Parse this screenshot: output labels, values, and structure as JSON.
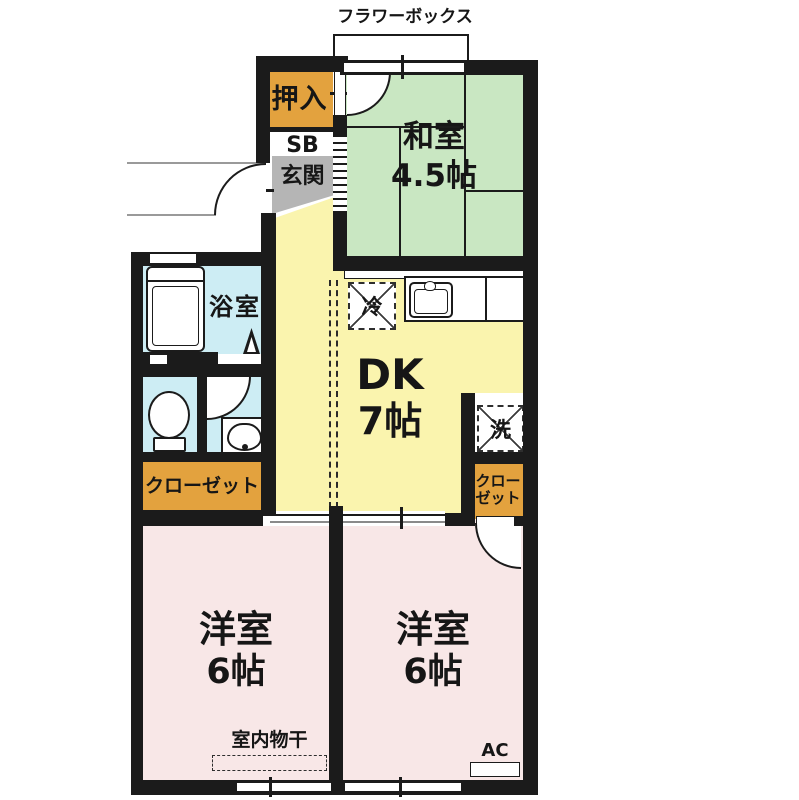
{
  "plan_title": "2DK apartment floor plan",
  "rooms": {
    "washitsu": {
      "name": "和室",
      "size": "4.5帖"
    },
    "dk": {
      "name": "DK",
      "size": "7帖"
    },
    "western_left": {
      "name": "洋室",
      "size": "6帖"
    },
    "western_right": {
      "name": "洋室",
      "size": "6帖"
    },
    "bathroom": {
      "name": "浴室"
    },
    "genkan": {
      "name": "玄関"
    },
    "shoe_box": {
      "name": "SB"
    },
    "oshiire": {
      "name": "押入"
    },
    "closet_left": {
      "name": "クローゼット"
    },
    "closet_right": {
      "line1": "クロー",
      "line2": "ゼット"
    }
  },
  "fixtures": {
    "flower_box": "フラワーボックス",
    "refrigerator": "冷",
    "washing_machine": "洗",
    "indoor_drying": "室内物干",
    "air_conditioner": "AC"
  },
  "colors": {
    "wall": "#1b1b1b",
    "tatami_green": "#c9e7c2",
    "dk_yellow": "#faf4ae",
    "western_pink": "#f8e7e7",
    "wet_area_blue": "#cdedf4",
    "closet_orange": "#e3a23e",
    "genkan_gray": "#b5b5b5"
  }
}
